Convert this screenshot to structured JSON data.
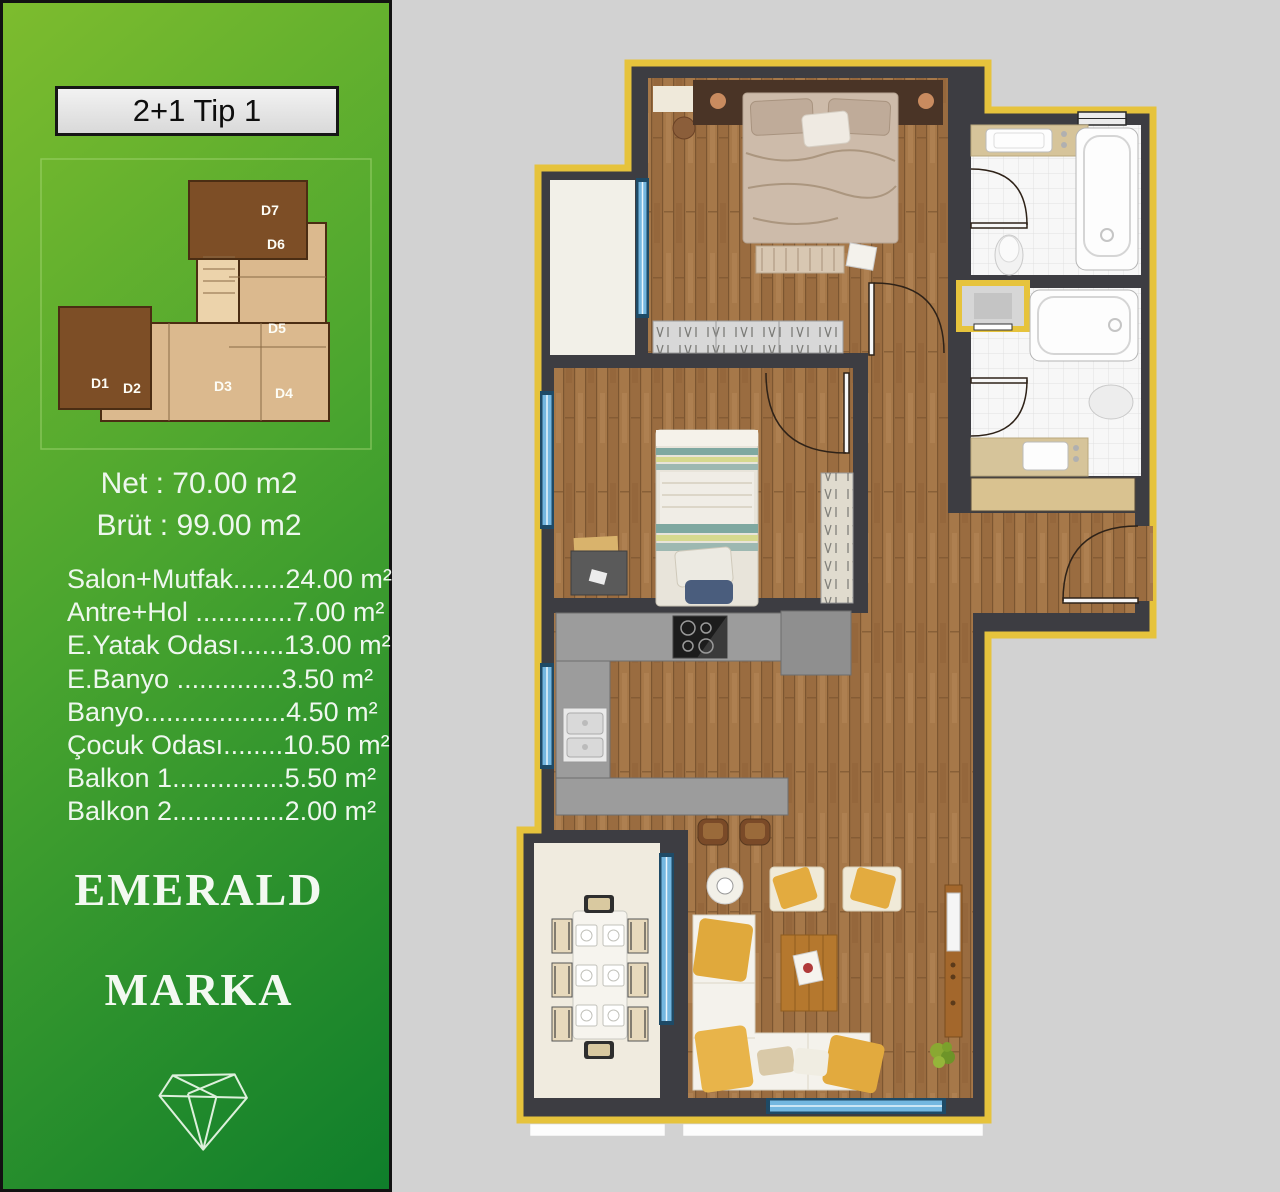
{
  "sidebar": {
    "title": "2+1 Tip 1",
    "net": "Net : 70.00 m2",
    "brut": "Brüt : 99.00 m2",
    "areas": [
      "Salon+Mutfak.......24.00 m²",
      "Antre+Hol .............7.00 m²",
      "E.Yatak Odası......13.00 m²",
      "E.Banyo ..............3.50 m²",
      "Banyo...................4.50 m²",
      "Çocuk Odası........10.50 m²",
      "Balkon 1...............5.50 m²",
      "Balkon 2...............2.00 m²"
    ],
    "brand": {
      "line1": "EMERALD",
      "line2": "MARKA"
    },
    "key_plan": {
      "units": [
        "D1",
        "D2",
        "D3",
        "D4",
        "D5",
        "D6",
        "D7"
      ]
    }
  },
  "colors": {
    "sidebar_green_light": "#7dbc2e",
    "sidebar_green_dark": "#0f7e2b",
    "plan_outline_yellow": "#e6c33c",
    "wall_dark": "#3d3d42",
    "background_gray": "#d2d2d2",
    "window_blue": "#74b7e0",
    "wood_floor": "#a67849",
    "highlight_unit_brown": "#7d4e26",
    "unit_tan": "#dbb98e"
  }
}
